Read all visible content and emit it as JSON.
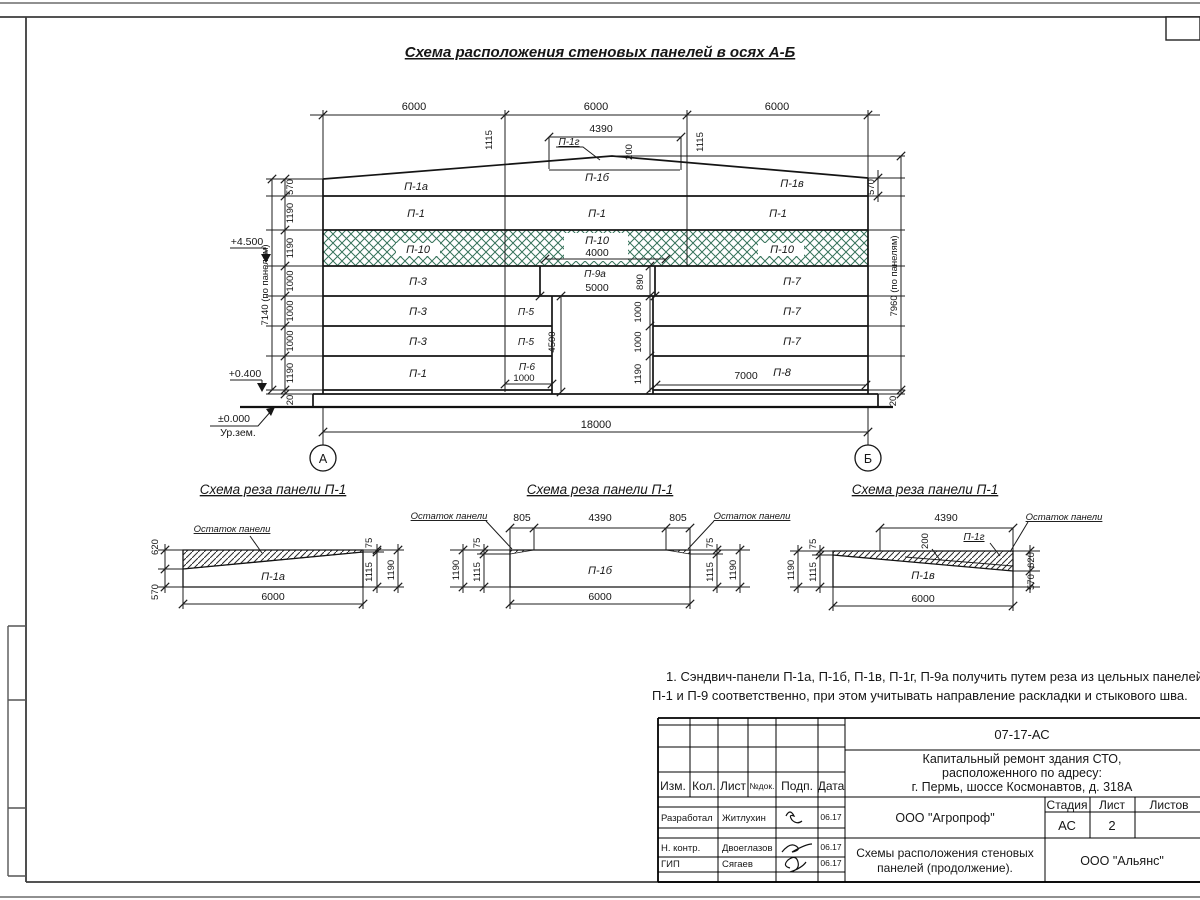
{
  "title": "Схема расположения стеновых панелей в осях А-Б",
  "elev": {
    "top_dims": [
      "6000",
      "6000",
      "6000"
    ],
    "d4390": "4390",
    "d1115l": "1115",
    "d1115r": "1115",
    "d200": "200",
    "p1g": "П-1г",
    "roof": [
      "П-1а",
      "П-1б",
      "П-1в"
    ],
    "p1row": [
      "П-1",
      "П-1",
      "П-1"
    ],
    "p10": [
      "П-10",
      "П-10",
      "П-10"
    ],
    "d4000": "4000",
    "colA": [
      "П-3",
      "П-3",
      "П-3",
      "П-1"
    ],
    "colM": [
      "П-5",
      "П-5",
      "П-6"
    ],
    "d1000": "1000",
    "p9a": "П-9а",
    "d5000": "5000",
    "d890": "890",
    "d4500": "4500",
    "colB": [
      "П-7",
      "П-7",
      "П-7",
      "П-8"
    ],
    "d7000": "7000",
    "door_chain": [
      "1000",
      "1000",
      "1190"
    ],
    "lchain": [
      "570",
      "1190",
      "1190",
      "1000",
      "1000",
      "1000",
      "1190"
    ],
    "l20": "20",
    "ltotal": "7140 (по панелям)",
    "r570": "570",
    "rtotal": "7960 (по панелям)",
    "r20": "20",
    "mk1": "+4.500",
    "mk2": "+0.400",
    "mk3": "±0.000",
    "mk4": "Ур.зем.",
    "d18000": "18000",
    "axisA": "А",
    "axisB": "Б"
  },
  "s1": {
    "title": "Схема реза панели П-1",
    "rem": "Остаток панели",
    "panel": "П-1а",
    "d620": "620",
    "d570": "570",
    "d75": "75",
    "d1115": "1115",
    "d1190": "1190",
    "d6000": "6000"
  },
  "s2": {
    "title": "Схема реза панели П-1",
    "reml": "Остаток панели",
    "remr": "Остаток панели",
    "panel": "П-1б",
    "d805l": "805",
    "d4390": "4390",
    "d805r": "805",
    "d75l": "75",
    "d1115l": "1115",
    "d1190l": "1190",
    "d75r": "75",
    "d1115r": "1115",
    "d1190r": "1190",
    "d6000": "6000"
  },
  "s3": {
    "title": "Схема реза панели П-1",
    "rem": "Остаток панели",
    "panel": "П-1в",
    "p1g": "П-1г",
    "d4390": "4390",
    "d200": "200",
    "d75": "75",
    "d1115": "1115",
    "d1190": "1190",
    "d620": "620",
    "d570": "570",
    "d6000": "6000"
  },
  "note1": "1. Сэндвич-панели П-1а, П-1б, П-1в, П-1г, П-9а получить путем реза из цельных панелей",
  "note2": "П-1 и П-9 соответственно, при этом учитывать направление раскладки и стыкового шва.",
  "tb": {
    "doc_number": "07-17-АС",
    "project1": "Капитальный ремонт здания СТО,",
    "project2": "расположенного по адресу:",
    "project3": "г. Пермь, шоссе Космонавтов, д. 318А",
    "h_izm": "Изм.",
    "h_kol": "Кол.",
    "h_list": "Лист",
    "h_ndok": "№док.",
    "h_podp": "Подп.",
    "h_data": "Дата",
    "r1_role": "Разработал",
    "r1_name": "Житлухин",
    "r1_date": "06.17",
    "r2_role": "Н. контр.",
    "r2_name": "Двоеглазов",
    "r2_date": "06.17",
    "r3_role": "ГИП",
    "r3_name": "Сягаев",
    "r3_date": "06.17",
    "org": "ООО \"Агропроф\"",
    "h_stage": "Стадия",
    "h_sheet": "Лист",
    "h_sheets": "Листов",
    "stage": "АС",
    "sheet_num": "2",
    "sheet_title1": "Схемы расположения стеновых",
    "sheet_title2": "панелей (продолжение).",
    "org2": "ООО \"Альянс\""
  }
}
